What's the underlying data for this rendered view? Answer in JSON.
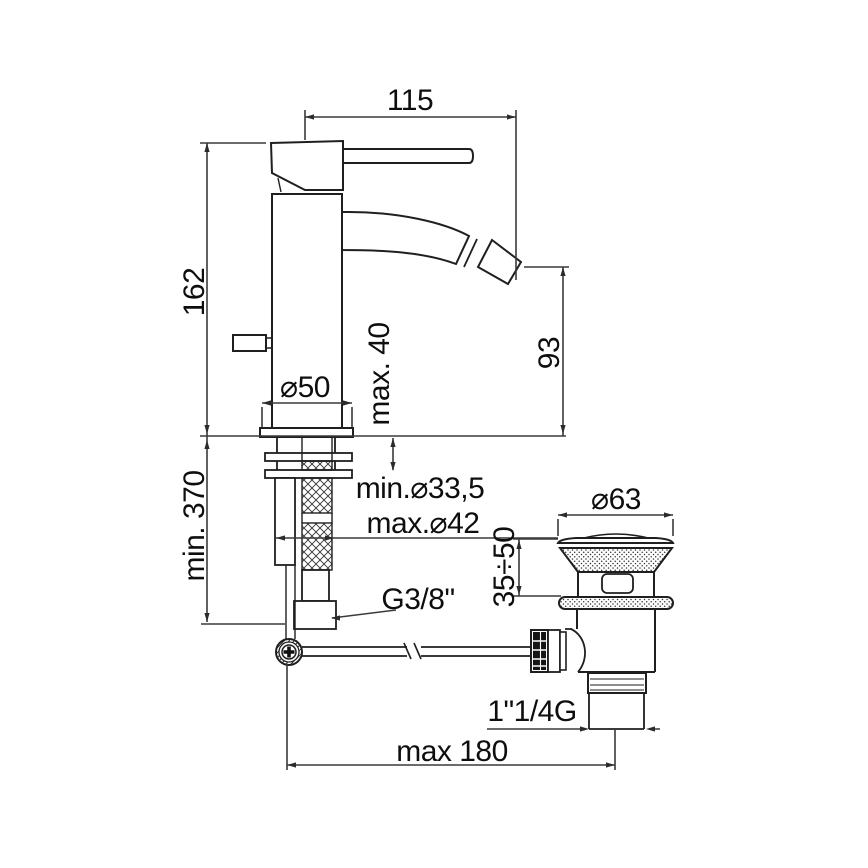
{
  "drawing_type": "technical-dimension-drawing",
  "subject": "single-lever bidet mixer with flexible inlet hoses and pop-up waste",
  "labels": {
    "width_115": "115",
    "height_162": "162",
    "deck_max40": "max. 40",
    "spout_93": "93",
    "dia50": "⌀50",
    "hose_min370": "min. 370",
    "hole_min": "min.⌀33,5",
    "hole_max": "max.⌀42",
    "inlet_thread": "G3/8\"",
    "dia63": "⌀63",
    "clamp_3550": "35÷50",
    "outlet_thread": "1\"1/4G",
    "reach_max180": "max 180"
  },
  "colors": {
    "background": "#ffffff",
    "object_line": "#1f1f1f",
    "dimension_line": "#3a3a3a",
    "text": "#0e0e0e"
  }
}
